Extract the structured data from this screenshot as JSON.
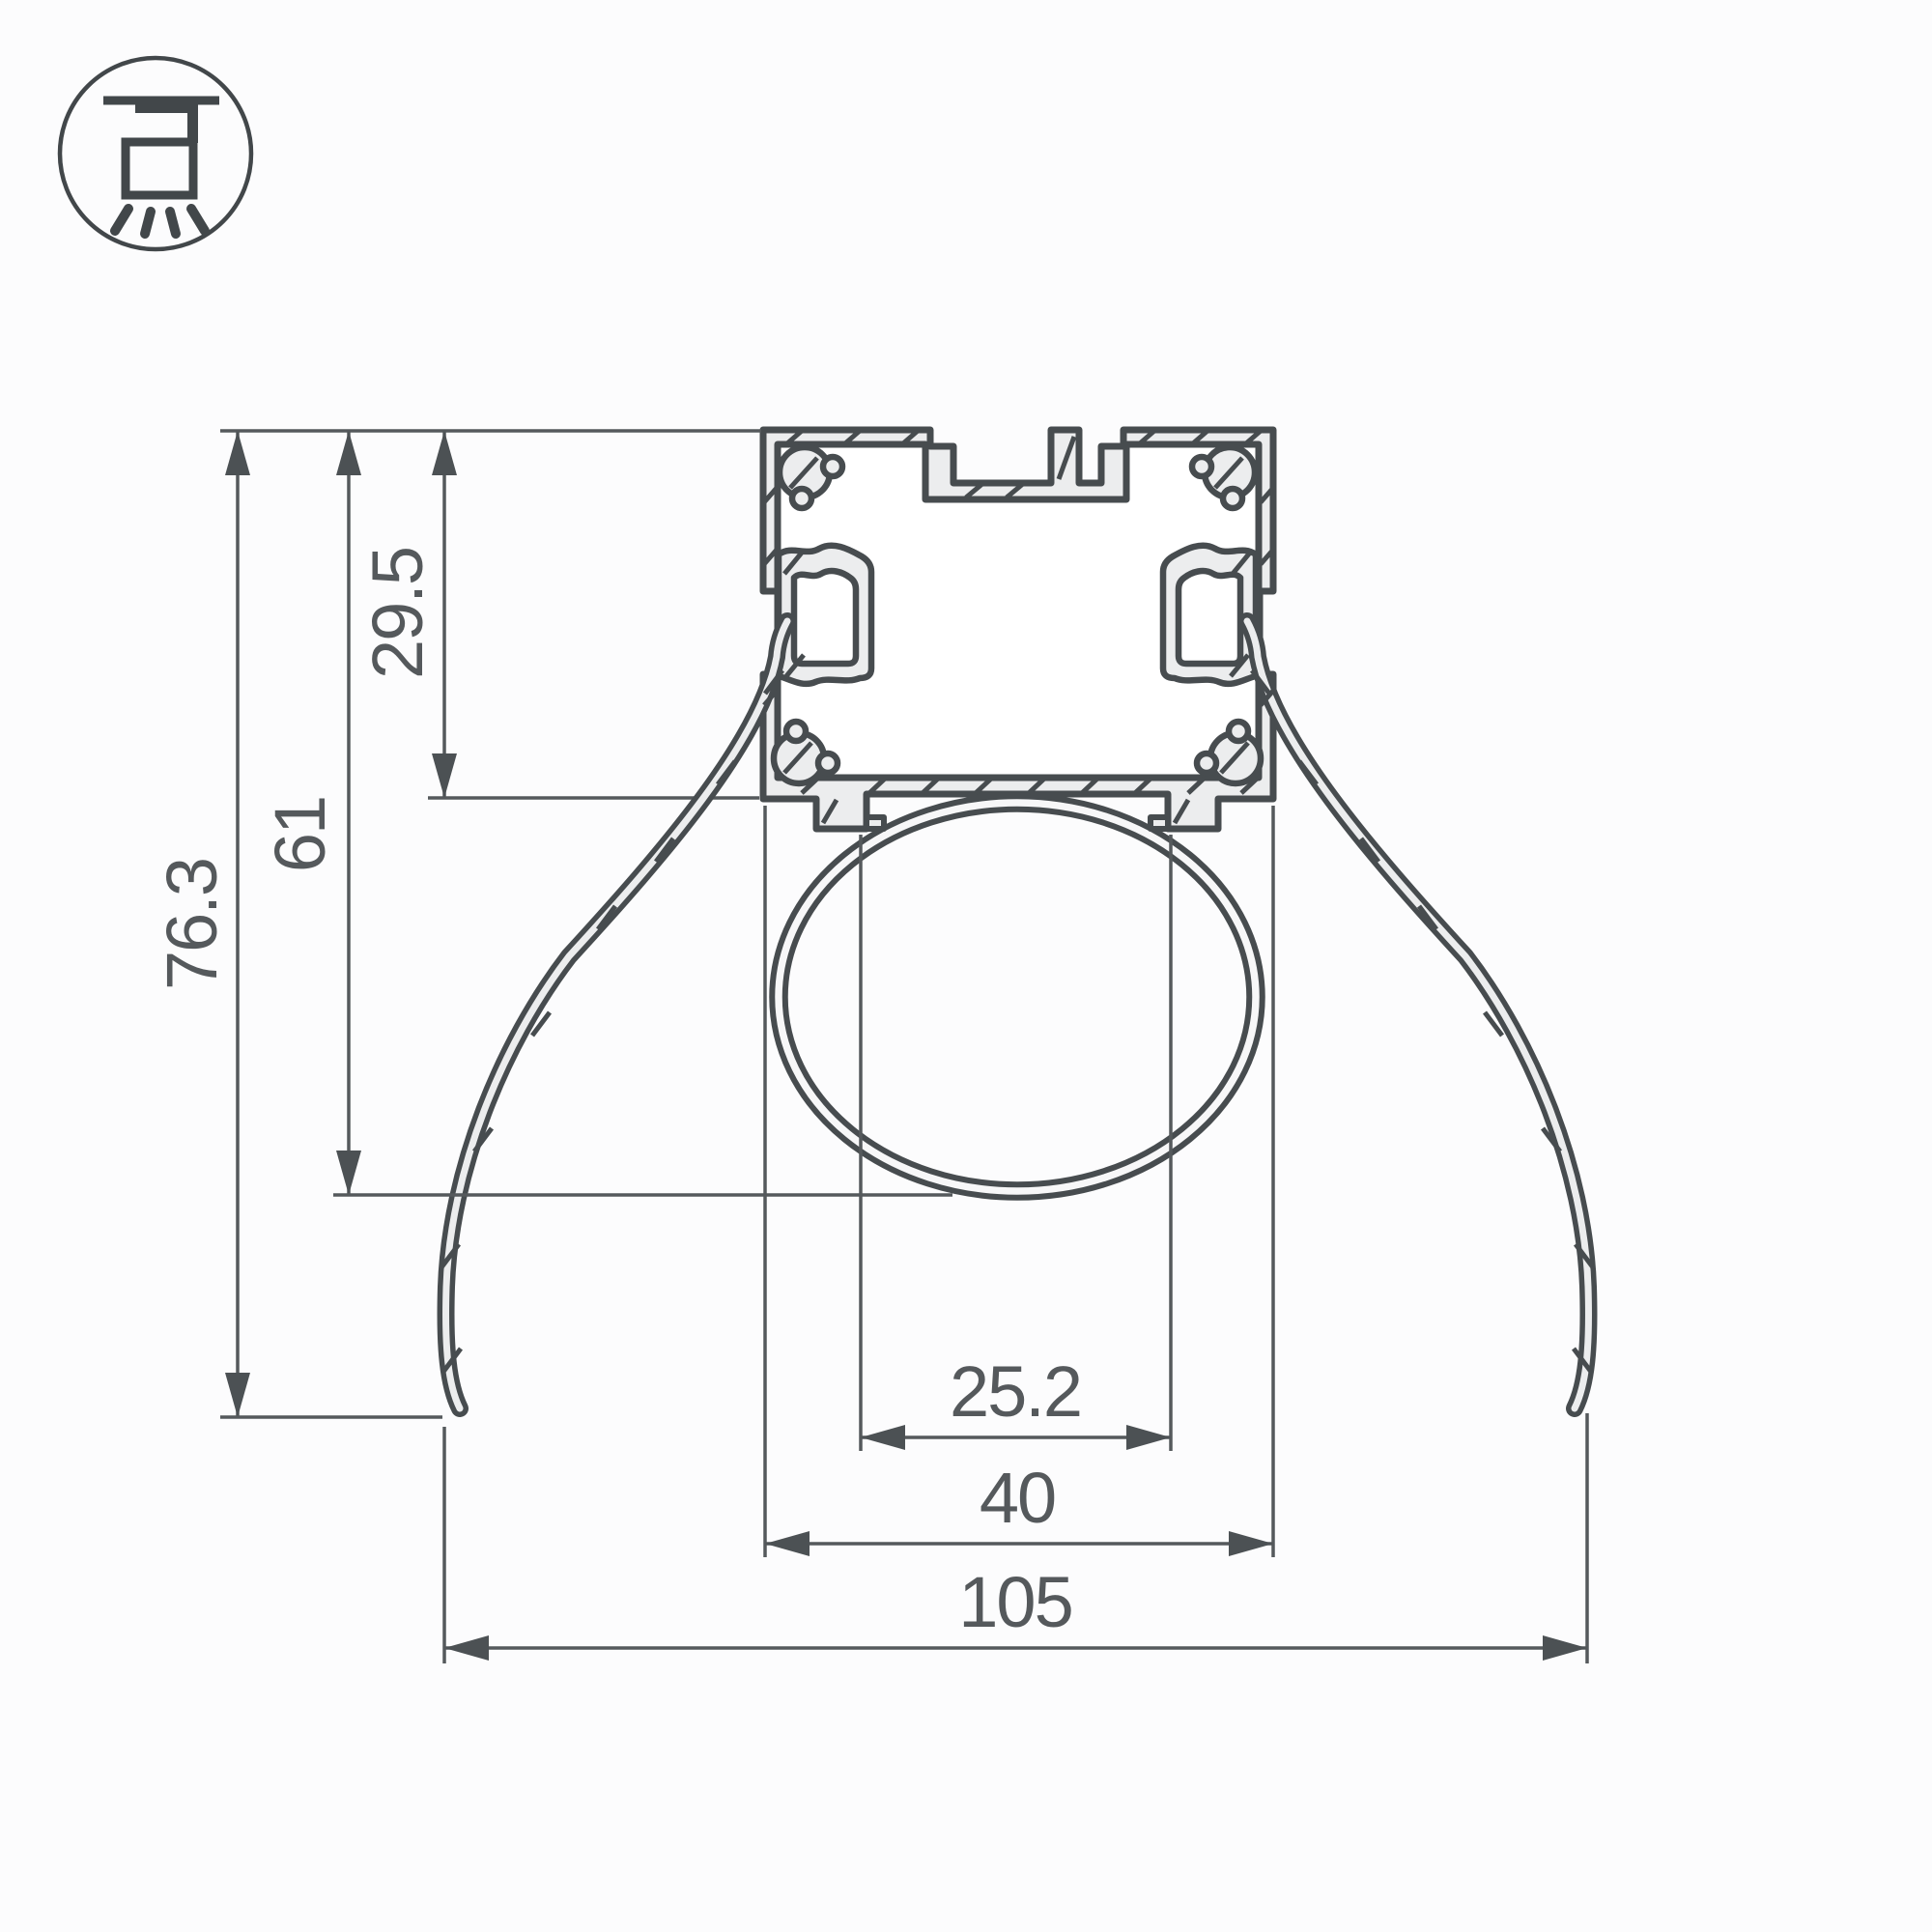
{
  "drawing": {
    "title": "LED profile cross-section technical drawing",
    "icon": {
      "name": "ceiling-mount-light-icon"
    },
    "dimensions": {
      "profile_height": "29.5",
      "height_to_lens_bottom": "61",
      "total_height": "76.3",
      "lens_mouth_width": "25.2",
      "profile_width": "40",
      "total_width": "105"
    },
    "colors": {
      "outline": "#474c4f",
      "dimension_lines": "#55595c",
      "material_fill": "#ecedee",
      "background": "#fcfcfd"
    }
  }
}
